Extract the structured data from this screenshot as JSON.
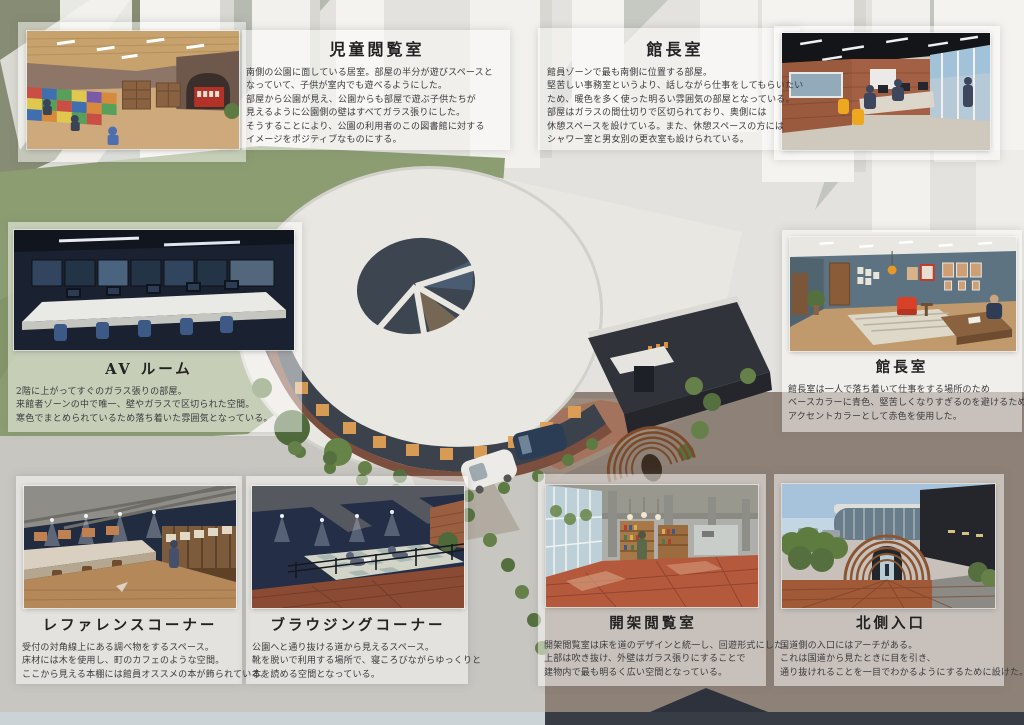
{
  "board": {
    "type": "architectural-presentation-board",
    "subject": "library design proposal"
  },
  "colors": {
    "sage_green": "#8C9D72",
    "taupe_ground": "#8E8177",
    "light_gray_ground": "#C8C6C1",
    "roof_white": "#E9E7E2",
    "dark_wing": "#2F3238",
    "brick_path": "#A5705A",
    "bottom_strip_light": "#CCD3D7",
    "bottom_strip_dark": "#383C44"
  },
  "sections": {
    "children_reading": {
      "title": "児童閲覧室",
      "lines": [
        "南側の公園に面している居室。部屋の半分が遊びスペースと",
        "なっていて、子供が室内でも遊べるようにした。",
        "部屋から公園が見え、公園からも部屋で遊ぶ子供たちが",
        "見えるように公園側の壁はすべてガラス張りにした。",
        "そうすることにより、公園の利用者のこの図書館に対する",
        "イメージをポジティブなものにする。"
      ]
    },
    "office": {
      "title": "館長室",
      "lines": [
        "館員ゾーンで最も南側に位置する部屋。",
        "堅苦しい事務室というより、話しながら仕事をしてもらいたい",
        "ため、暖色を多く使った明るい雰囲気の部屋となっている。",
        "部屋はガラスの間仕切りで区切られており、奥側には",
        "休憩スペースを設けている。また、休憩スペースの方には",
        "シャワー室と男女別の更衣室も設けられている。"
      ]
    },
    "av_room": {
      "title": "AV ルーム",
      "lines": [
        "2階に上がってすぐのガラス張りの部屋。",
        "来館者ゾーンの中で唯一、壁やガラスで区切られた空間。",
        "寒色でまとめられているため落ち着いた雰囲気となっている。"
      ]
    },
    "director_room": {
      "title": "館長室",
      "lines": [
        "館長室は一人で落ち着いて仕事をする場所のため",
        "ベースカラーに青色、堅苦しくなりすぎるのを避けるため、",
        "アクセントカラーとして赤色を使用した。"
      ]
    },
    "reference_corner": {
      "title": "レファレンスコーナー",
      "lines": [
        "受付の対角線上にある調べ物をするスペース。",
        "床材には木を使用し、町のカフェのような空間。",
        "ここから見える本棚には館員オススメの本が飾られている。"
      ]
    },
    "browsing_corner": {
      "title": "ブラウジングコーナー",
      "lines": [
        "公園へと通り抜ける道から見えるスペース。",
        "靴を脱いで利用する場所で、寝ころびながらゆっくりと",
        "本を読める空間となっている。"
      ]
    },
    "open_stack": {
      "title": "開架閲覧室",
      "lines": [
        "開架閲覧室は床を道のデザインと統一し、回遊形式にした。",
        "上部は吹き抜け、外壁はガラス張りにすることで",
        "建物内で最も明るく広い空間となっている。"
      ]
    },
    "north_entrance": {
      "title": "北側入口",
      "lines": [
        "国道側の入口にはアーチがある。",
        "これは国道から見たときに目を引き、",
        "通り抜けれることを一目でわかるようにするために設けた。"
      ]
    }
  }
}
